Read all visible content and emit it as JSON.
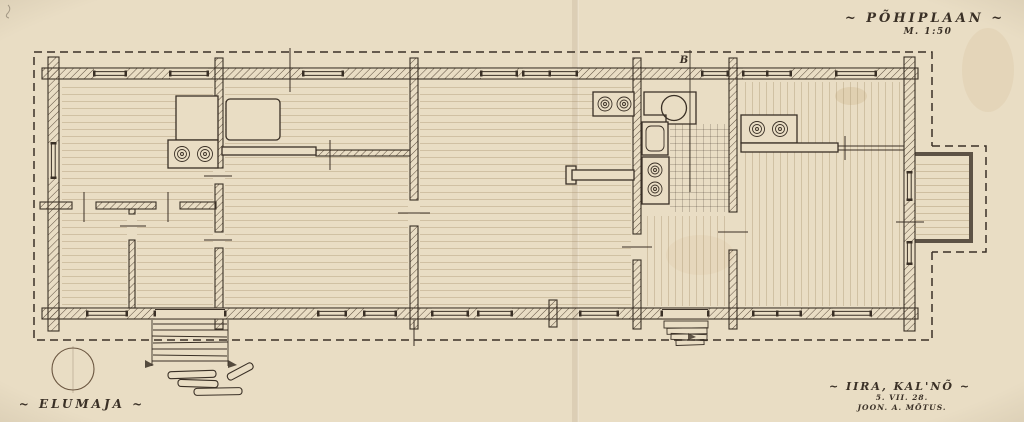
{
  "titleblock": {
    "title": "~ PÕHIPLAAN ~",
    "scale": "M. 1:50"
  },
  "captions": {
    "building": "~ ELUMAJA ~",
    "location": "~ IIRA, KAL'NÕ ~",
    "date": "5. VII. 28.",
    "author": "JOON. A. MÕTUS."
  },
  "marks": {
    "section": "B"
  },
  "colors": {
    "paper": "#e9ddc4",
    "ink": "#3a3026",
    "hatch": "#5d4e3e",
    "faint": "#a8946f"
  }
}
